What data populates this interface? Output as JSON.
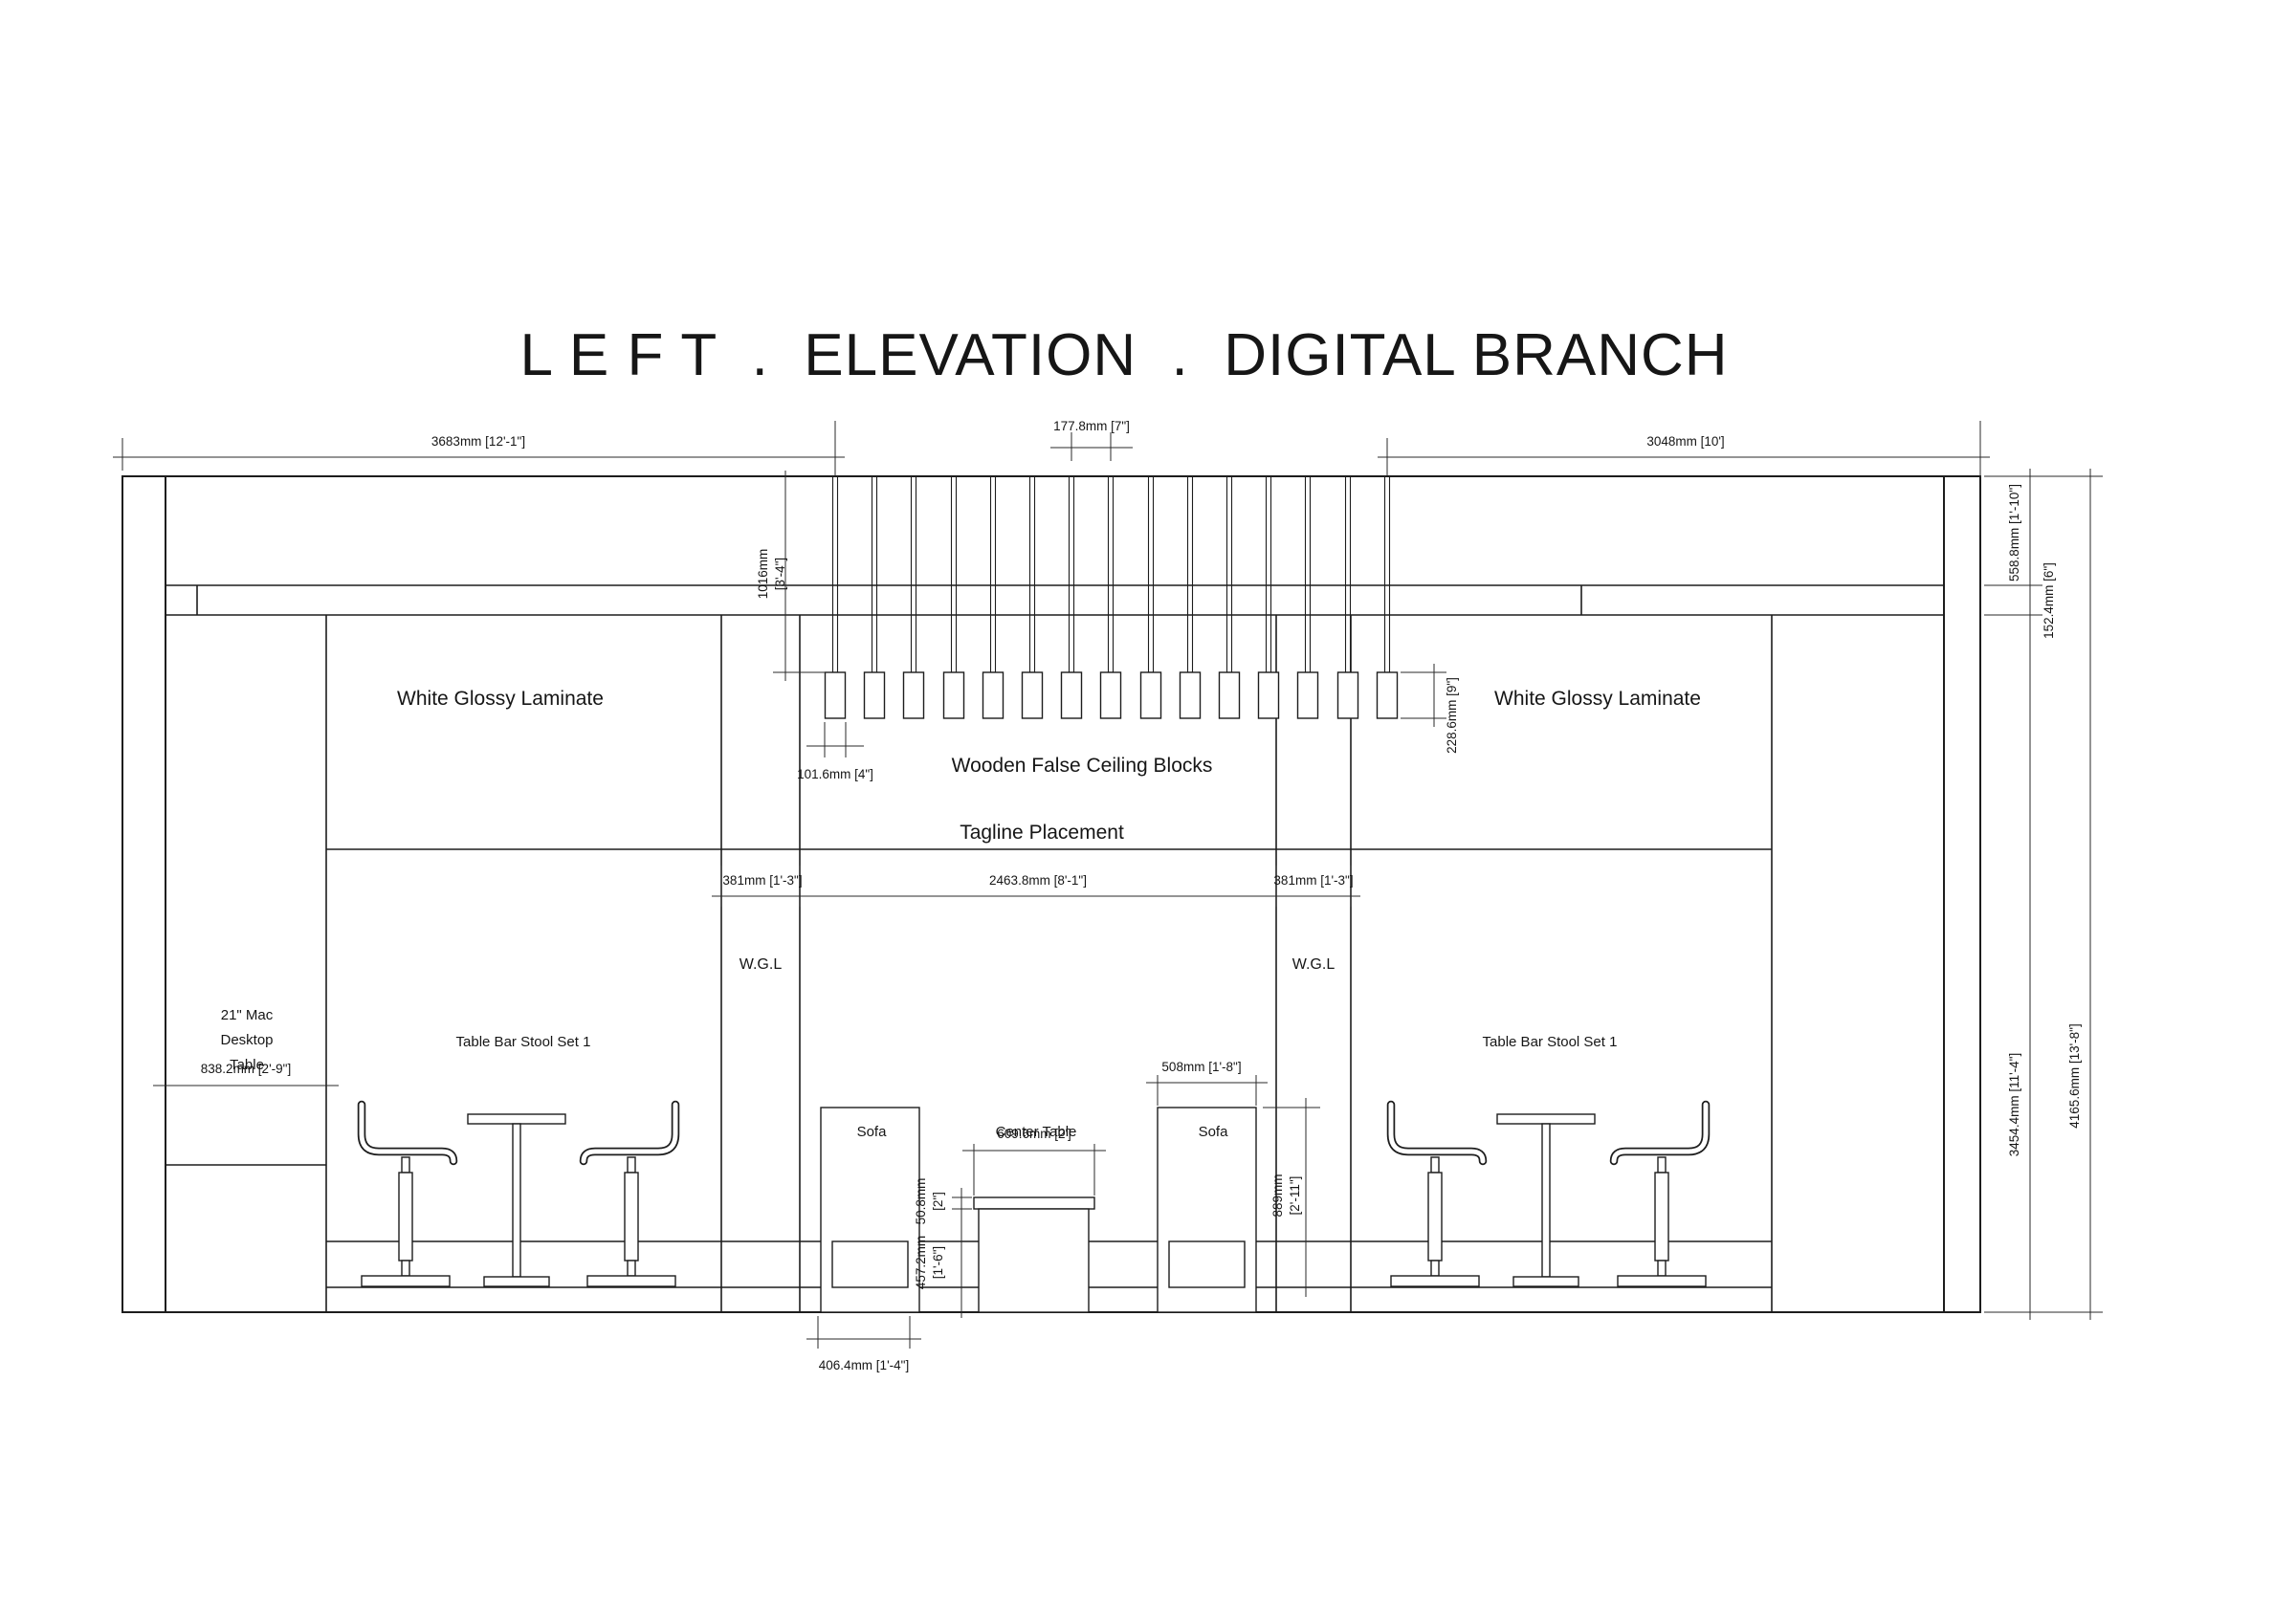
{
  "title": "L E F T  .  ELEVATION  .  DIGITAL BRANCH",
  "labels": {
    "white_glossy_left": "White Glossy Laminate",
    "white_glossy_right": "White Glossy Laminate",
    "wooden_false_ceiling_blocks": "Wooden False Ceiling Blocks",
    "tagline_placement": "Tagline Placement",
    "wgl_left": "W.G.L",
    "wgl_right": "W.G.L",
    "mac_desktop_table": [
      "21\" Mac",
      "Desktop",
      "Table"
    ],
    "table_bar_stool_left": "Table Bar Stool Set 1",
    "table_bar_stool_right": "Table Bar Stool Set 1",
    "sofa_left": "Sofa",
    "sofa_right": "Sofa",
    "center_table": "Center Table"
  },
  "dimensions": {
    "wall_left_width": "3683mm [12'-1\"]",
    "pendant_spacing": "177.8mm [7\"]",
    "wall_right_width": "3048mm [10']",
    "pendant_drop": [
      "1016mm",
      "[3'-4\"]"
    ],
    "block_width": "101.6mm [4\"]",
    "block_height": "228.6mm [9\"]",
    "fascia_height": "558.8mm [1'-10\"]",
    "band_height": "152.4mm [6\"]",
    "wall_body_height": "3454.4mm [11'-4\"]",
    "total_height": "4165.6mm [13'-8\"]",
    "wgl_left_width": "381mm [1'-3\"]",
    "center_span": "2463.8mm [8'-1\"]",
    "wgl_right_width": "381mm [1'-3\"]",
    "desk_width": "838.2mm [2'-9\"]",
    "sofa_width": "508mm [1'-8\"]",
    "table_top_width": "609.6mm [2']",
    "table_top_thickness": [
      "50.8mm",
      "[2\"]"
    ],
    "table_height": [
      "457.2mm",
      "[1'-6\"]"
    ],
    "sofa_height": [
      "889mm",
      "[2'-11\"]"
    ],
    "base_width": "406.4mm [1'-4\"]"
  },
  "colors": {
    "line": "#1d1d1d",
    "background": "#ffffff"
  }
}
